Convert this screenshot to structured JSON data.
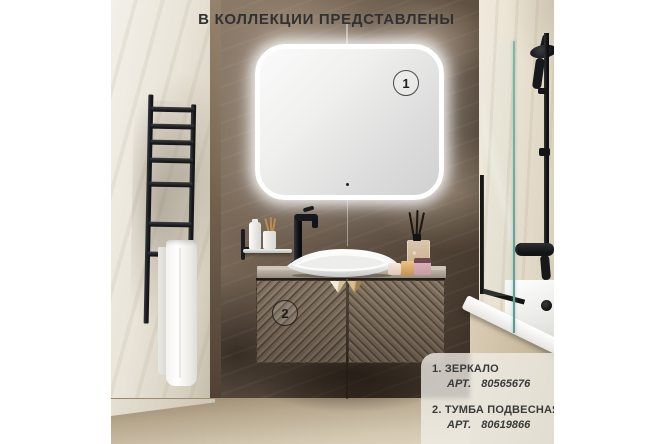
{
  "title": "В КОЛЛЕКЦИИ ПРЕДСТАВЛЕНЫ",
  "markers": {
    "mirror_number": "1",
    "vanity_number": "2"
  },
  "legend": {
    "items": [
      {
        "num": "1.",
        "name": "ЗЕРКАЛО",
        "art_label": "АРТ.",
        "art_number": "80565676"
      },
      {
        "num": "2.",
        "name": "ТУМБА ПОДВЕСНАЯ",
        "art_label": "АРТ.",
        "art_number": "80619866"
      }
    ]
  },
  "colors": {
    "title_text": "#313131",
    "legend_text": "#3a3a3a",
    "glass_edge_teal": "#6aa99d",
    "brass_handle": "#c3a868",
    "legend_panel_background": "rgba(240,237,231,0.78)"
  }
}
